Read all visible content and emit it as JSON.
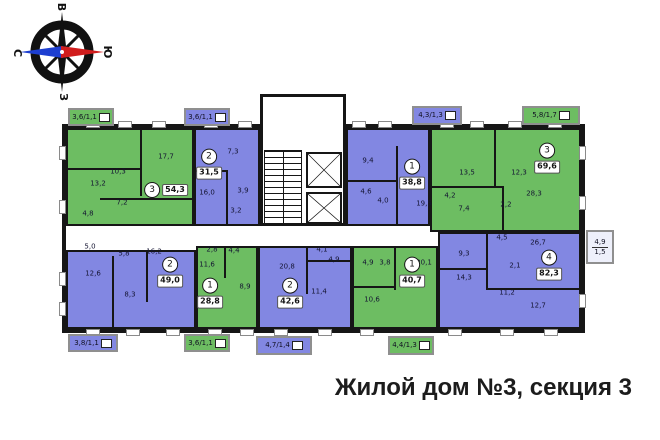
{
  "title": "Жилой дом №3, секция 3",
  "compass": {
    "top": "В",
    "left": "С",
    "right": "Ю",
    "bottom": "З"
  },
  "colors": {
    "green": "#6dbd62",
    "blue": "#8287e2",
    "wall": "#161616"
  },
  "plan": {
    "outline": {
      "x": 62,
      "y": 124,
      "w": 523,
      "h": 209
    },
    "core": {
      "x": 260,
      "y": 94,
      "w": 86,
      "h": 132
    },
    "stairs": {
      "x": 264,
      "y": 150,
      "w": 38,
      "h": 74
    },
    "elevators": [
      {
        "x": 306,
        "y": 152,
        "w": 36,
        "h": 36
      },
      {
        "x": 306,
        "y": 192,
        "w": 36,
        "h": 32
      }
    ],
    "apartments": [
      {
        "num": "3",
        "area": "54,3",
        "color": "green",
        "rect": {
          "x": 66,
          "y": 128,
          "w": 128,
          "h": 98
        },
        "label": {
          "x": 166,
          "y": 190,
          "layout": "row"
        },
        "rooms": [
          {
            "v": "13,2",
            "x": 98,
            "y": 184
          },
          {
            "v": "10,3",
            "x": 118,
            "y": 172
          },
          {
            "v": "17,7",
            "x": 166,
            "y": 157
          },
          {
            "v": "7,2",
            "x": 122,
            "y": 203
          },
          {
            "v": "4,8",
            "x": 88,
            "y": 214
          }
        ]
      },
      {
        "num": "2",
        "area": "31,5",
        "color": "blue",
        "rect": {
          "x": 194,
          "y": 128,
          "w": 66,
          "h": 98
        },
        "label": {
          "x": 209,
          "y": 164,
          "layout": "col"
        },
        "rooms": [
          {
            "v": "7,3",
            "x": 233,
            "y": 152
          },
          {
            "v": "16,0",
            "x": 207,
            "y": 193
          },
          {
            "v": "3,9",
            "x": 243,
            "y": 191
          },
          {
            "v": "3,2",
            "x": 236,
            "y": 211
          }
        ]
      },
      {
        "num": "1",
        "area": "38,8",
        "color": "blue",
        "rect": {
          "x": 346,
          "y": 128,
          "w": 84,
          "h": 98
        },
        "label": {
          "x": 412,
          "y": 174,
          "layout": "col"
        },
        "rooms": [
          {
            "v": "9,4",
            "x": 368,
            "y": 161
          },
          {
            "v": "4,6",
            "x": 366,
            "y": 192
          },
          {
            "v": "4,0",
            "x": 383,
            "y": 201
          },
          {
            "v": "19,5",
            "x": 424,
            "y": 204
          }
        ]
      },
      {
        "num": "3",
        "area": "69,6",
        "color": "green",
        "rect": {
          "x": 430,
          "y": 128,
          "w": 151,
          "h": 104
        },
        "label": {
          "x": 547,
          "y": 158,
          "layout": "col"
        },
        "rooms": [
          {
            "v": "13,5",
            "x": 467,
            "y": 173
          },
          {
            "v": "12,3",
            "x": 519,
            "y": 173
          },
          {
            "v": "4,2",
            "x": 450,
            "y": 196
          },
          {
            "v": "7,4",
            "x": 464,
            "y": 209
          },
          {
            "v": "2,2",
            "x": 506,
            "y": 205
          },
          {
            "v": "28,3",
            "x": 534,
            "y": 194
          }
        ]
      },
      {
        "num": "2",
        "area": "49,0",
        "color": "blue",
        "rect": {
          "x": 66,
          "y": 250,
          "w": 130,
          "h": 79
        },
        "label": {
          "x": 170,
          "y": 272,
          "layout": "col"
        },
        "rooms": [
          {
            "v": "5,0",
            "x": 90,
            "y": 247
          },
          {
            "v": "5,8",
            "x": 124,
            "y": 254
          },
          {
            "v": "16,2",
            "x": 154,
            "y": 252
          },
          {
            "v": "12,6",
            "x": 93,
            "y": 274
          },
          {
            "v": "8,3",
            "x": 130,
            "y": 295
          }
        ]
      },
      {
        "num": "1",
        "area": "28,8",
        "color": "green",
        "rect": {
          "x": 196,
          "y": 246,
          "w": 62,
          "h": 83
        },
        "label": {
          "x": 210,
          "y": 293,
          "layout": "col"
        },
        "rooms": [
          {
            "v": "2,8",
            "x": 212,
            "y": 250
          },
          {
            "v": "4,4",
            "x": 234,
            "y": 251
          },
          {
            "v": "11,6",
            "x": 207,
            "y": 265
          },
          {
            "v": "8,9",
            "x": 245,
            "y": 287
          }
        ]
      },
      {
        "num": "2",
        "area": "42,6",
        "color": "blue",
        "rect": {
          "x": 258,
          "y": 246,
          "w": 94,
          "h": 83
        },
        "label": {
          "x": 290,
          "y": 293,
          "layout": "col"
        },
        "rooms": [
          {
            "v": "20,8",
            "x": 287,
            "y": 267
          },
          {
            "v": "4,1",
            "x": 322,
            "y": 250
          },
          {
            "v": "4,9",
            "x": 334,
            "y": 260
          },
          {
            "v": "11,4",
            "x": 319,
            "y": 292
          }
        ]
      },
      {
        "num": "1",
        "area": "40,7",
        "color": "green",
        "rect": {
          "x": 352,
          "y": 246,
          "w": 86,
          "h": 83
        },
        "label": {
          "x": 412,
          "y": 272,
          "layout": "col"
        },
        "rooms": [
          {
            "v": "4,9",
            "x": 368,
            "y": 263
          },
          {
            "v": "3,8",
            "x": 385,
            "y": 263
          },
          {
            "v": "20,1",
            "x": 424,
            "y": 263
          },
          {
            "v": "10,6",
            "x": 372,
            "y": 300
          }
        ]
      },
      {
        "num": "4",
        "area": "82,3",
        "color": "blue",
        "rect": {
          "x": 438,
          "y": 232,
          "w": 143,
          "h": 97
        },
        "label": {
          "x": 549,
          "y": 265,
          "layout": "col"
        },
        "rooms": [
          {
            "v": "4,5",
            "x": 502,
            "y": 238
          },
          {
            "v": "26,7",
            "x": 538,
            "y": 243
          },
          {
            "v": "9,3",
            "x": 464,
            "y": 254
          },
          {
            "v": "14,3",
            "x": 464,
            "y": 278
          },
          {
            "v": "2,1",
            "x": 515,
            "y": 266
          },
          {
            "v": "11,2",
            "x": 507,
            "y": 293
          },
          {
            "v": "12,7",
            "x": 538,
            "y": 306
          }
        ]
      }
    ],
    "balconies": [
      {
        "v": "3,6/1,1",
        "c": "green",
        "x": 68,
        "y": 108,
        "w": 46,
        "h": 18
      },
      {
        "v": "3,6/1,1",
        "c": "blue",
        "x": 184,
        "y": 108,
        "w": 46,
        "h": 18
      },
      {
        "v": "4,3/1,3",
        "c": "blue",
        "x": 412,
        "y": 106,
        "w": 50,
        "h": 19
      },
      {
        "v": "5,8/1,7",
        "c": "green",
        "x": 522,
        "y": 106,
        "w": 58,
        "h": 19
      },
      {
        "v": "3,8/1,1",
        "c": "blue",
        "x": 68,
        "y": 334,
        "w": 50,
        "h": 18
      },
      {
        "v": "3,6/1,1",
        "c": "green",
        "x": 184,
        "y": 334,
        "w": 46,
        "h": 18
      },
      {
        "v": "4,7/1,4",
        "c": "blue",
        "x": 256,
        "y": 336,
        "w": 56,
        "h": 19
      },
      {
        "v": "4,4/1,3",
        "c": "green",
        "x": 388,
        "y": 336,
        "w": 46,
        "h": 19
      }
    ],
    "right_balcony": {
      "v1": "4,9",
      "v2": "1,5",
      "x": 586,
      "y": 230,
      "w": 28,
      "h": 34
    },
    "walls": [
      {
        "x": 140,
        "y": 128,
        "w": 2,
        "h": 68
      },
      {
        "x": 66,
        "y": 168,
        "w": 75,
        "h": 2
      },
      {
        "x": 100,
        "y": 198,
        "w": 94,
        "h": 2
      },
      {
        "x": 194,
        "y": 170,
        "w": 34,
        "h": 2
      },
      {
        "x": 226,
        "y": 170,
        "w": 2,
        "h": 56
      },
      {
        "x": 396,
        "y": 146,
        "w": 2,
        "h": 80
      },
      {
        "x": 346,
        "y": 180,
        "w": 52,
        "h": 2
      },
      {
        "x": 494,
        "y": 128,
        "w": 2,
        "h": 58
      },
      {
        "x": 430,
        "y": 186,
        "w": 74,
        "h": 2
      },
      {
        "x": 502,
        "y": 186,
        "w": 2,
        "h": 46
      },
      {
        "x": 112,
        "y": 256,
        "w": 2,
        "h": 73
      },
      {
        "x": 146,
        "y": 250,
        "w": 2,
        "h": 52
      },
      {
        "x": 224,
        "y": 246,
        "w": 2,
        "h": 32
      },
      {
        "x": 306,
        "y": 246,
        "w": 2,
        "h": 48
      },
      {
        "x": 306,
        "y": 260,
        "w": 46,
        "h": 2
      },
      {
        "x": 394,
        "y": 246,
        "w": 2,
        "h": 44
      },
      {
        "x": 352,
        "y": 286,
        "w": 44,
        "h": 2
      },
      {
        "x": 486,
        "y": 232,
        "w": 2,
        "h": 58
      },
      {
        "x": 438,
        "y": 268,
        "w": 50,
        "h": 2
      },
      {
        "x": 486,
        "y": 288,
        "w": 95,
        "h": 2
      },
      {
        "x": 260,
        "y": 146,
        "w": 86,
        "h": 2
      }
    ],
    "windows": [
      {
        "x": 86,
        "y": 121,
        "w": 14,
        "h": 7
      },
      {
        "x": 118,
        "y": 121,
        "w": 14,
        "h": 7
      },
      {
        "x": 152,
        "y": 121,
        "w": 14,
        "h": 7
      },
      {
        "x": 204,
        "y": 121,
        "w": 14,
        "h": 7
      },
      {
        "x": 238,
        "y": 121,
        "w": 14,
        "h": 7
      },
      {
        "x": 352,
        "y": 121,
        "w": 14,
        "h": 7
      },
      {
        "x": 378,
        "y": 121,
        "w": 14,
        "h": 7
      },
      {
        "x": 440,
        "y": 121,
        "w": 14,
        "h": 7
      },
      {
        "x": 470,
        "y": 121,
        "w": 14,
        "h": 7
      },
      {
        "x": 508,
        "y": 121,
        "w": 14,
        "h": 7
      },
      {
        "x": 548,
        "y": 121,
        "w": 14,
        "h": 7
      },
      {
        "x": 86,
        "y": 329,
        "w": 14,
        "h": 7
      },
      {
        "x": 126,
        "y": 329,
        "w": 14,
        "h": 7
      },
      {
        "x": 166,
        "y": 329,
        "w": 14,
        "h": 7
      },
      {
        "x": 208,
        "y": 329,
        "w": 14,
        "h": 7
      },
      {
        "x": 240,
        "y": 329,
        "w": 14,
        "h": 7
      },
      {
        "x": 274,
        "y": 329,
        "w": 14,
        "h": 7
      },
      {
        "x": 318,
        "y": 329,
        "w": 14,
        "h": 7
      },
      {
        "x": 360,
        "y": 329,
        "w": 14,
        "h": 7
      },
      {
        "x": 448,
        "y": 329,
        "w": 14,
        "h": 7
      },
      {
        "x": 500,
        "y": 329,
        "w": 14,
        "h": 7
      },
      {
        "x": 544,
        "y": 329,
        "w": 14,
        "h": 7
      },
      {
        "x": 59,
        "y": 146,
        "w": 7,
        "h": 14
      },
      {
        "x": 59,
        "y": 200,
        "w": 7,
        "h": 14
      },
      {
        "x": 59,
        "y": 272,
        "w": 7,
        "h": 14
      },
      {
        "x": 59,
        "y": 302,
        "w": 7,
        "h": 14
      },
      {
        "x": 579,
        "y": 146,
        "w": 7,
        "h": 14
      },
      {
        "x": 579,
        "y": 196,
        "w": 7,
        "h": 14
      },
      {
        "x": 579,
        "y": 294,
        "w": 7,
        "h": 14
      }
    ]
  }
}
